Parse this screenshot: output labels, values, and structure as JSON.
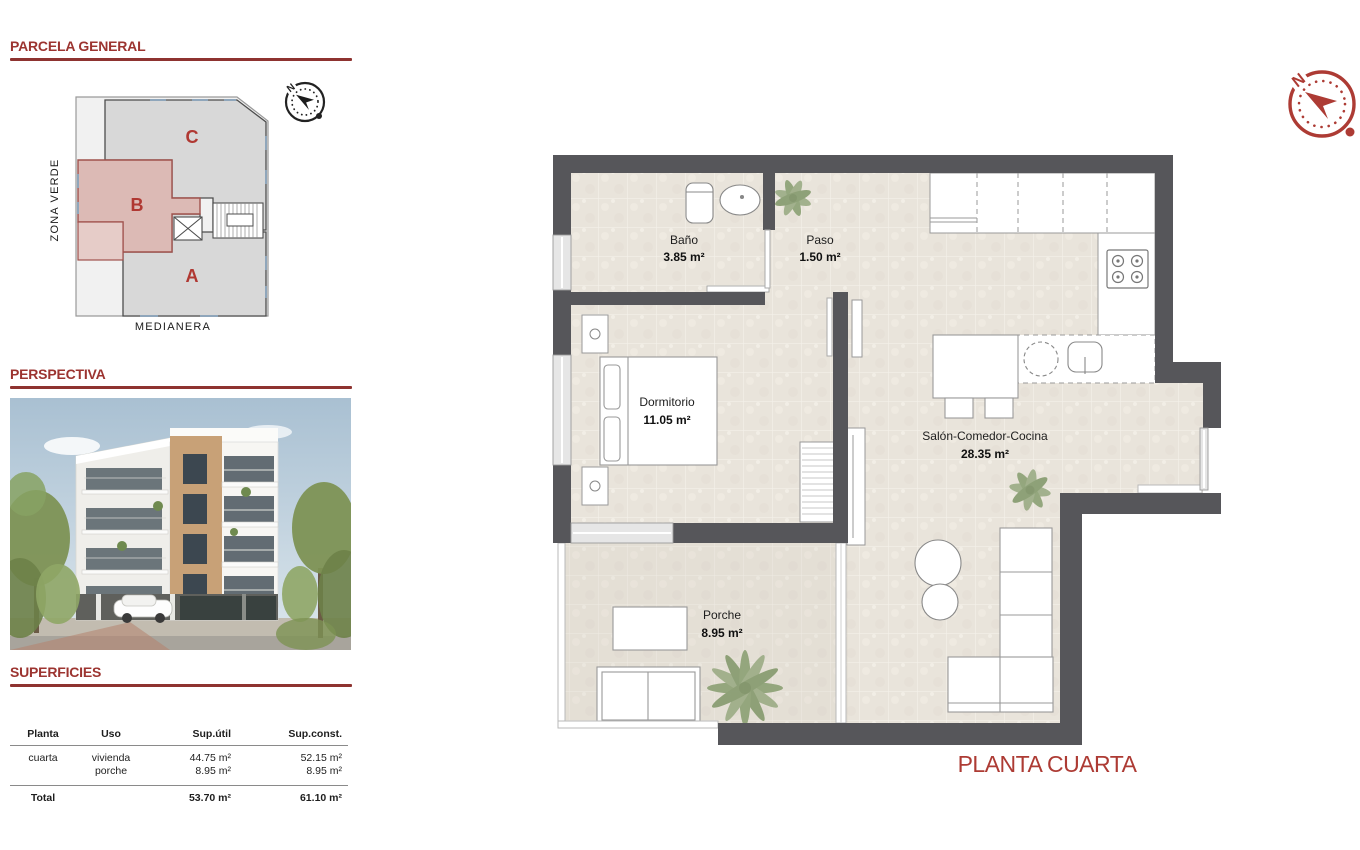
{
  "headings": {
    "parcela": "PARCELA GENERAL",
    "perspectiva": "PERSPECTIVA",
    "superficies": "SUPERFICIES"
  },
  "parcela": {
    "zones": [
      "A",
      "B",
      "C"
    ],
    "zona_verde": "ZONA VERDE",
    "medianera": "MEDIANERA",
    "compass_n": "N"
  },
  "floorplan": {
    "title": "PLANTA CUARTA",
    "compass_n": "N",
    "rooms": [
      {
        "name": "Baño",
        "area": "3.85 m²"
      },
      {
        "name": "Paso",
        "area": "1.50 m²"
      },
      {
        "name": "Dormitorio",
        "area": "11.05 m²"
      },
      {
        "name": "Salón-Comedor-Cocina",
        "area": "28.35 m²"
      },
      {
        "name": "Porche",
        "area": "8.95 m²"
      }
    ]
  },
  "surfaces": {
    "columns": [
      "Planta",
      "Uso",
      "Sup.útil",
      "Sup.const."
    ],
    "row": {
      "planta": "cuarta",
      "uso1": "vivienda",
      "uso2": "porche",
      "util1": "44.75 m²",
      "util2": "8.95 m²",
      "const1": "52.15 m²",
      "const2": "8.95 m²"
    },
    "total": {
      "label": "Total",
      "util": "53.70 m²",
      "const": "61.10 m²"
    }
  },
  "colors": {
    "accent_red": "#9c3430",
    "compass_red": "#ad3b34",
    "wall_gray": "#56565a",
    "floor_beige": "#e9e4db",
    "zone_b_pink": "#dcbab5",
    "zone_gray": "#d8d8d8"
  }
}
